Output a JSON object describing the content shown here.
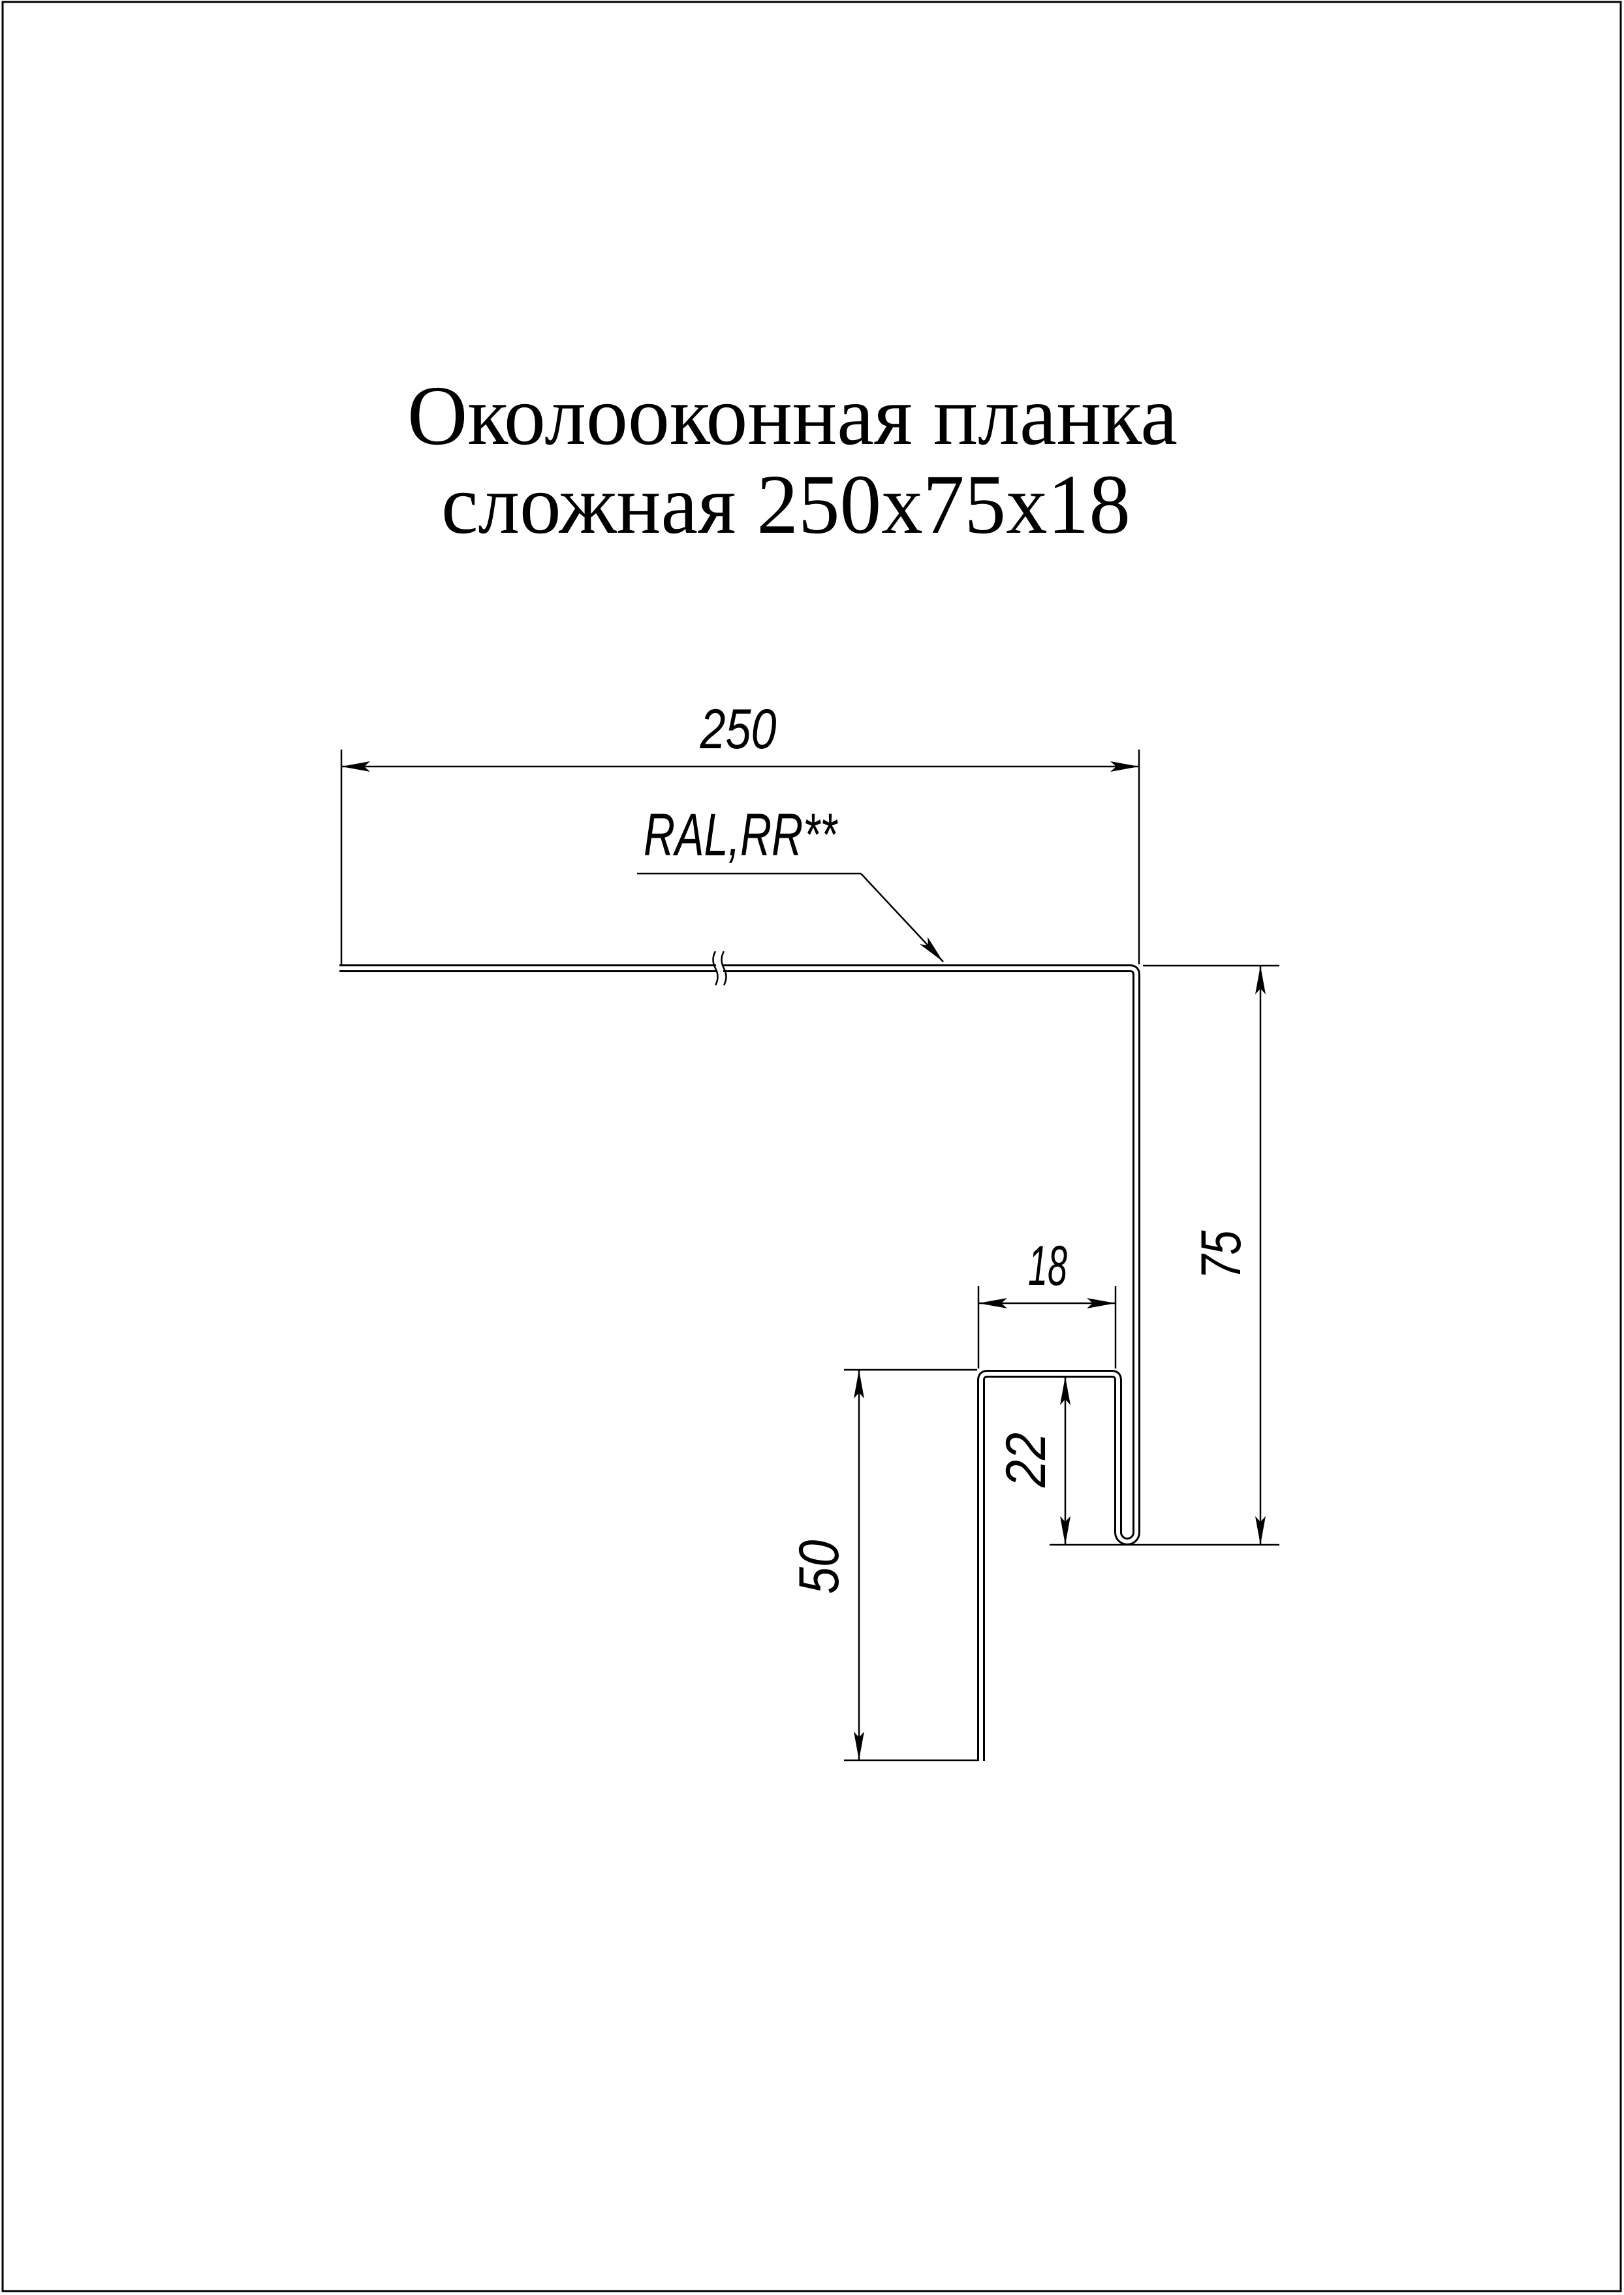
{
  "title": {
    "line1": "Околооконная планка",
    "line2": "сложная 250х75х18"
  },
  "annotation": {
    "coating_label": "RAL,RR**"
  },
  "dimensions": {
    "flange_width": "250",
    "side_height": "75",
    "hem_width": "18",
    "hem_height": "22",
    "leg_height": "50"
  },
  "style": {
    "line_color": "#000000",
    "background_color": "#ffffff"
  }
}
